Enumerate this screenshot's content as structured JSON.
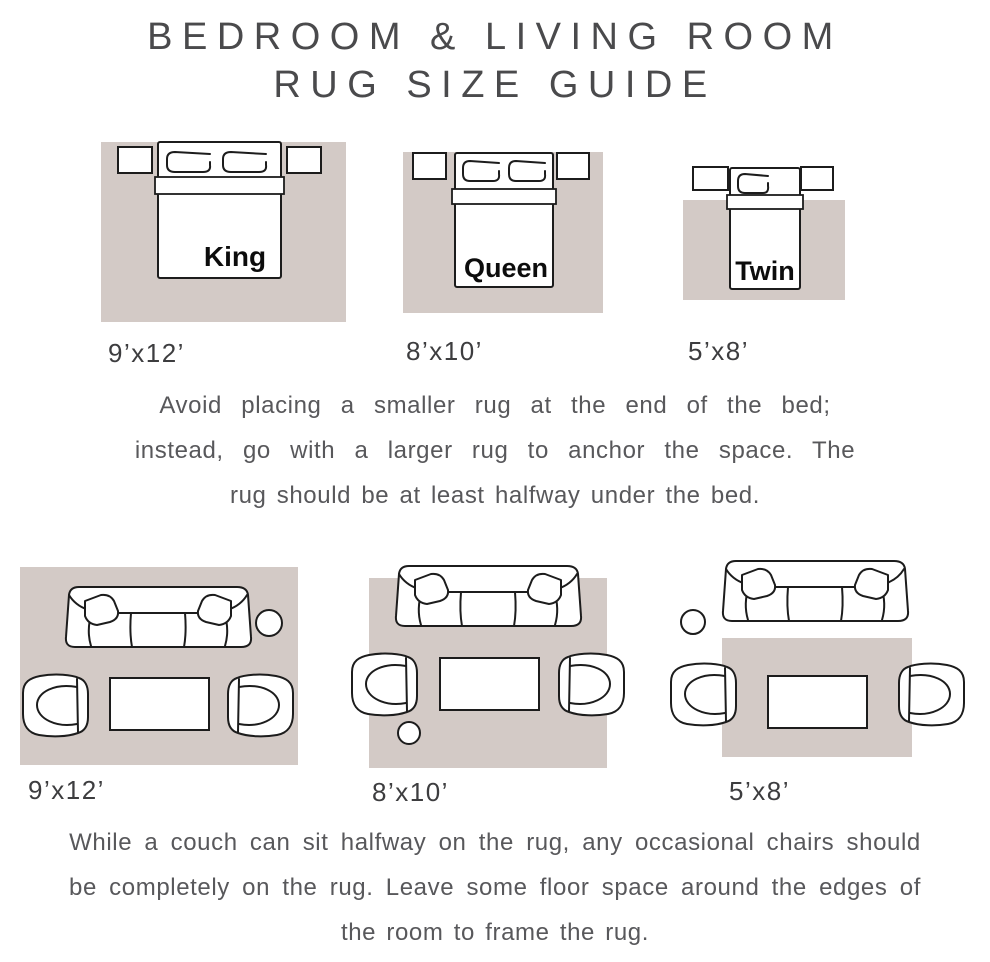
{
  "title": {
    "line1": "BEDROOM & LIVING ROOM",
    "line2": "RUG SIZE GUIDE"
  },
  "colors": {
    "rug": "#d3cac6",
    "furniture_outline": "#1c1c1c",
    "furniture_fill": "#ffffff",
    "title_text": "#4a4a4c",
    "body_text": "#58585b",
    "size_label_text": "#3d3d3f",
    "bed_label_text": "#0c0c0c",
    "background": "#ffffff"
  },
  "bedroom_section": {
    "diagrams": [
      {
        "bed_label": "King",
        "rug_size": "9’x12’",
        "pillows": 2,
        "nightstands": 2,
        "rug_placement": "rug extends under bed and nightstands"
      },
      {
        "bed_label": "Queen",
        "rug_size": "8’x10’",
        "pillows": 2,
        "nightstands": 2,
        "rug_placement": "rug extends under bed and nightstands"
      },
      {
        "bed_label": "Twin",
        "rug_size": "5’x8’",
        "pillows": 1,
        "nightstands": 2,
        "rug_placement": "rug starts below nightstands, halfway under bed"
      }
    ],
    "note_lines": [
      "Avoid placing a smaller rug at the end of the bed;",
      "instead, go with a larger rug to anchor the space. The",
      "rug should be at least halfway under the bed."
    ]
  },
  "living_room_section": {
    "diagrams": [
      {
        "rug_size": "9’x12’",
        "furniture": [
          "sofa",
          "side table",
          "left armchair",
          "coffee table",
          "right armchair"
        ],
        "rug_placement": "all furniture fully on rug"
      },
      {
        "rug_size": "8’x10’",
        "furniture": [
          "sofa",
          "left armchair",
          "coffee table",
          "right armchair",
          "side table"
        ],
        "rug_placement": "sofa partly off top edge, chairs overlap side edges"
      },
      {
        "rug_size": "5’x8’",
        "furniture": [
          "side table",
          "sofa",
          "left armchair",
          "coffee table",
          "right armchair"
        ],
        "rug_placement": "sofa off rug, chairs overlap side edges"
      }
    ],
    "note_lines": [
      "While a couch can sit halfway on the rug, any occasional chairs should",
      "be completely on the rug. Leave some floor space around the edges of",
      "the room to frame the rug."
    ]
  }
}
